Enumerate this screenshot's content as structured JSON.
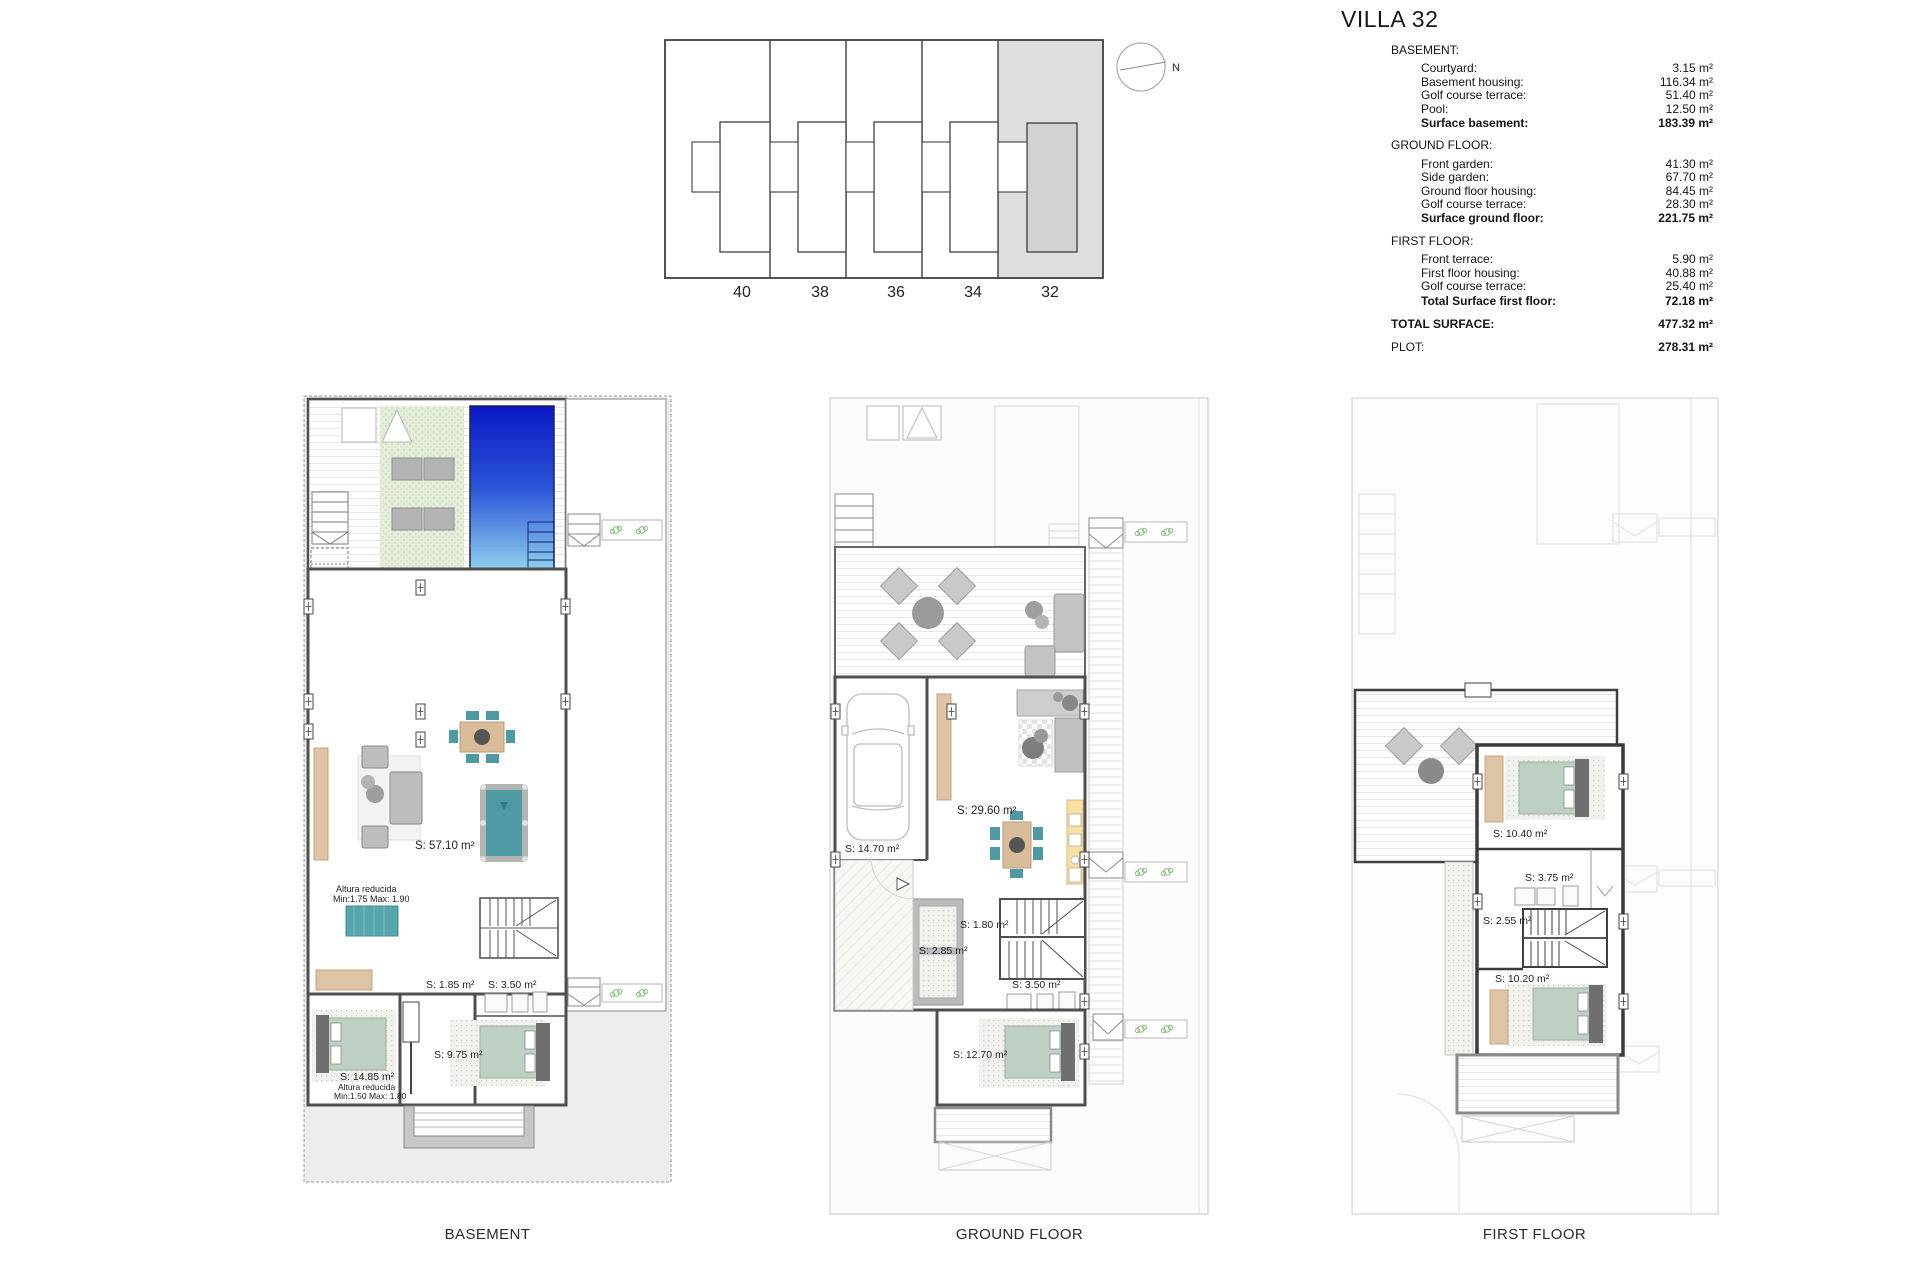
{
  "title": "VILLA 32",
  "compass": {
    "north_label": "N"
  },
  "site_plan": {
    "unit_numbers": [
      "40",
      "38",
      "36",
      "34",
      "32"
    ],
    "highlighted_unit": "32"
  },
  "surface_table": {
    "sections": [
      {
        "heading": "BASEMENT:",
        "rows": [
          {
            "label": "Courtyard:",
            "value": "3.15 m²"
          },
          {
            "label": "Basement housing:",
            "value": "116.34 m²"
          },
          {
            "label": "Golf course terrace:",
            "value": "51.40 m²"
          },
          {
            "label": "Pool:",
            "value": "12.50 m²"
          }
        ],
        "total": {
          "label": "Surface basement:",
          "value": "183.39 m²"
        }
      },
      {
        "heading": "GROUND FLOOR:",
        "rows": [
          {
            "label": "Front garden:",
            "value": "41.30 m²"
          },
          {
            "label": "Side garden:",
            "value": "67.70 m²"
          },
          {
            "label": "Ground floor housing:",
            "value": "84.45 m²"
          },
          {
            "label": "Golf course terrace:",
            "value": "28.30 m²"
          }
        ],
        "total": {
          "label": "Surface ground floor:",
          "value": "221.75 m²"
        }
      },
      {
        "heading": "FIRST FLOOR:",
        "rows": [
          {
            "label": "Front terrace:",
            "value": "5.90 m²"
          },
          {
            "label": "First floor housing:",
            "value": "40.88 m²"
          },
          {
            "label": "Golf course terrace:",
            "value": "25.40 m²"
          }
        ],
        "total": {
          "label": "Total Surface first floor:",
          "value": "72.18 m²"
        }
      }
    ],
    "grand_totals": [
      {
        "label": "TOTAL SURFACE:",
        "value": "477.32 m²"
      },
      {
        "label": "PLOT:",
        "value": "278.31 m²"
      }
    ]
  },
  "plans": {
    "basement": {
      "caption": "BASEMENT",
      "labels": {
        "living": "S: 57.10 m²",
        "height1_line1": "Altura reducida",
        "height1_line2": "Min:1.75 Max: 1.90",
        "storage": "S: 1.85 m²",
        "bathroom": "S: 3.50 m²",
        "hallway": "S: 9.75 m²",
        "bedroom": "S: 14.85 m²",
        "height2_line1": "Altura reducida",
        "height2_line2": "Min:1.50 Max: 1.80"
      }
    },
    "ground_floor": {
      "caption": "GROUND FLOOR",
      "labels": {
        "garage": "S: 14.70 m²",
        "living_kitchen": "S: 29.60 m²",
        "pantry": "S: 1.80 m²",
        "hallway": "S: 2.85 m²",
        "bathroom": "S: 3.50 m²",
        "bedroom": "S: 12.70 m²"
      }
    },
    "first_floor": {
      "caption": "FIRST FLOOR",
      "labels": {
        "bedroom1": "S: 10.40 m²",
        "bathroom": "S: 3.75 m²",
        "landing": "S: 2.55 m²",
        "bedroom2": "S: 10.20 m²"
      }
    }
  }
}
